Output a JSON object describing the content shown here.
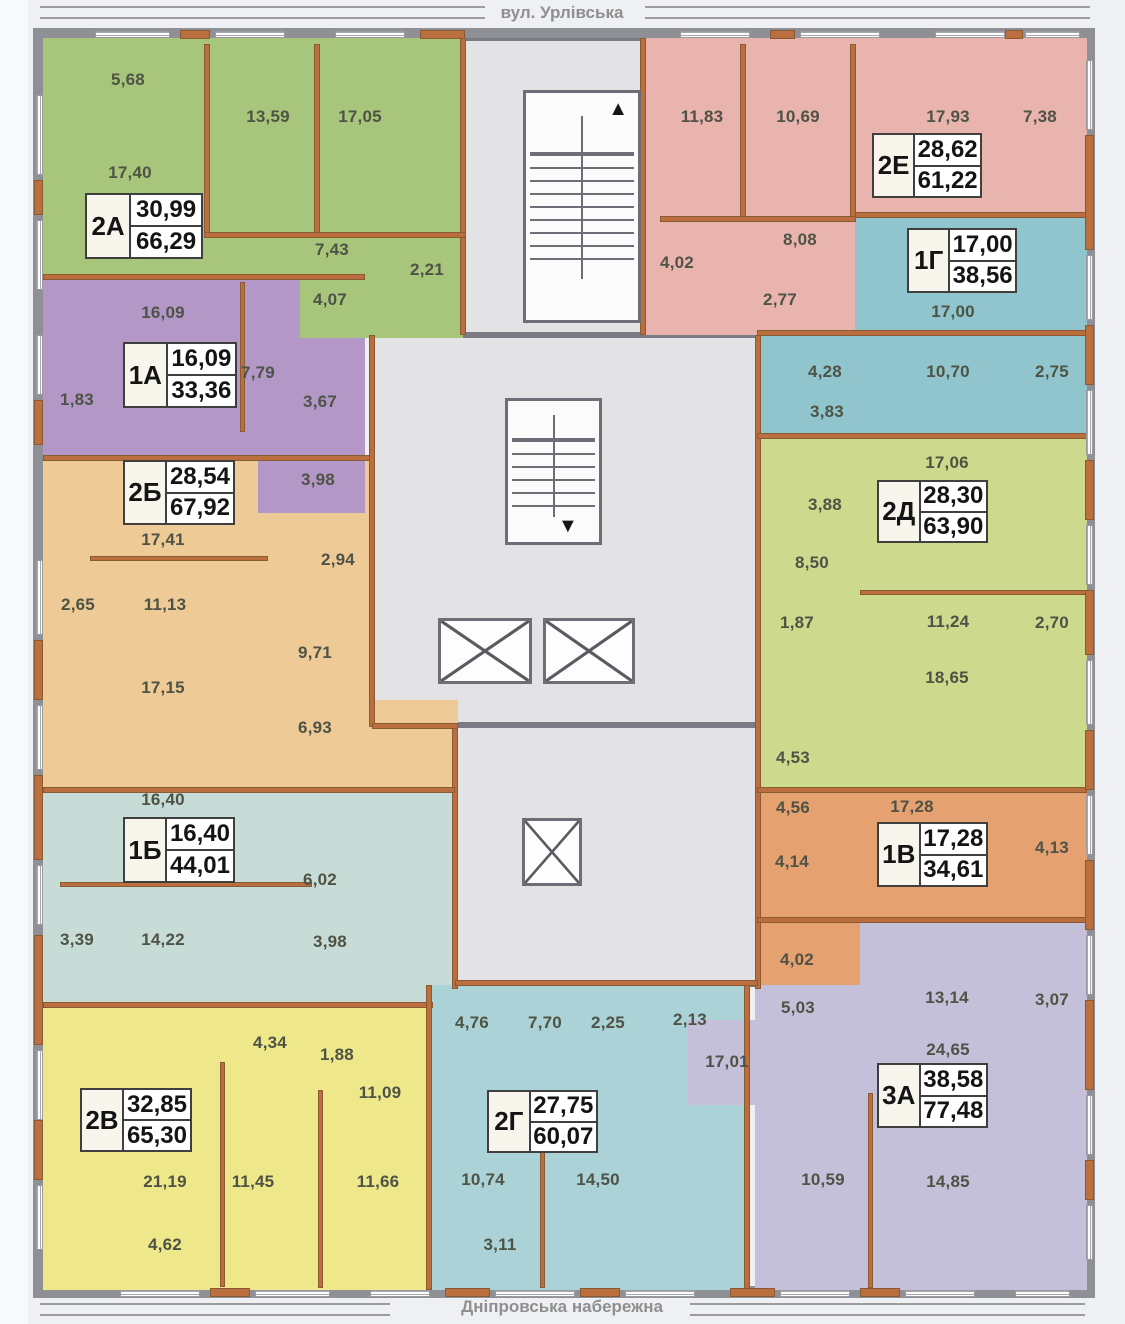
{
  "streets": {
    "top": "вул. Урлівська",
    "bottom": "Дніпровська набережна"
  },
  "legend": {
    "label_format": "apartment id | living area / total area (m²)",
    "room_label_color": "#4e5345",
    "wall_brick_color": "#bb6f3f",
    "wall_gray_color": "#8f8f96"
  },
  "plan": {
    "frame": [
      [
        33,
        28,
        1062,
        12
      ],
      [
        33,
        1286,
        1062,
        12
      ],
      [
        33,
        28,
        12,
        1270
      ],
      [
        1083,
        28,
        12,
        1270
      ]
    ],
    "core": {
      "rects": [
        [
          463,
          38,
          180,
          297
        ],
        [
          372,
          335,
          386,
          390
        ],
        [
          455,
          725,
          303,
          262
        ]
      ],
      "stairs": [
        {
          "rect": [
            523,
            90,
            118,
            233
          ],
          "dir": "up",
          "arrow": "▲"
        },
        {
          "rect": [
            505,
            398,
            97,
            147
          ],
          "dir": "down",
          "arrow": "▼"
        }
      ],
      "elevators": [
        [
          438,
          618,
          94,
          66
        ],
        [
          543,
          618,
          92,
          66
        ],
        [
          522,
          818,
          60,
          68
        ]
      ]
    },
    "apartments": [
      {
        "id": "2Б",
        "living": "28,54",
        "total": "67,92",
        "color": "#eeca96",
        "label": [
          123,
          460,
          112,
          65
        ],
        "regions": [
          [
            43,
            458,
            327,
            332
          ],
          [
            370,
            700,
            88,
            92
          ]
        ],
        "rooms": [
          {
            "v": "17,41",
            "x": 163,
            "y": 540
          },
          {
            "v": "2,94",
            "x": 338,
            "y": 560
          },
          {
            "v": "2,65",
            "x": 78,
            "y": 605
          },
          {
            "v": "11,13",
            "x": 165,
            "y": 605
          },
          {
            "v": "9,71",
            "x": 315,
            "y": 653
          },
          {
            "v": "17,15",
            "x": 163,
            "y": 688
          },
          {
            "v": "6,93",
            "x": 315,
            "y": 728
          }
        ]
      },
      {
        "id": "1А",
        "living": "16,09",
        "total": "33,36",
        "color": "#b297c7",
        "label": [
          123,
          342,
          114,
          66
        ],
        "regions": [
          [
            43,
            278,
            322,
            180
          ],
          [
            258,
            458,
            107,
            55
          ]
        ],
        "rooms": [
          {
            "v": "16,09",
            "x": 163,
            "y": 313
          },
          {
            "v": "7,79",
            "x": 258,
            "y": 373
          },
          {
            "v": "1,83",
            "x": 77,
            "y": 400
          },
          {
            "v": "3,67",
            "x": 320,
            "y": 402
          },
          {
            "v": "3,98",
            "x": 318,
            "y": 480
          }
        ]
      },
      {
        "id": "2А",
        "living": "30,99",
        "total": "66,29",
        "color": "#a7c67b",
        "label": [
          85,
          193,
          118,
          66
        ],
        "regions": [
          [
            43,
            38,
            420,
            240
          ],
          [
            300,
            278,
            163,
            60
          ]
        ],
        "rooms": [
          {
            "v": "5,68",
            "x": 128,
            "y": 80
          },
          {
            "v": "13,59",
            "x": 268,
            "y": 117
          },
          {
            "v": "17,05",
            "x": 360,
            "y": 117
          },
          {
            "v": "17,40",
            "x": 130,
            "y": 173
          },
          {
            "v": "7,43",
            "x": 332,
            "y": 250
          },
          {
            "v": "2,21",
            "x": 427,
            "y": 270
          },
          {
            "v": "4,07",
            "x": 330,
            "y": 300
          }
        ]
      },
      {
        "id": "1Б",
        "living": "16,40",
        "total": "44,01",
        "color": "#c7dbd7",
        "label": [
          123,
          817,
          112,
          66
        ],
        "regions": [
          [
            43,
            790,
            412,
            215
          ]
        ],
        "rooms": [
          {
            "v": "16,40",
            "x": 163,
            "y": 800
          },
          {
            "v": "6,02",
            "x": 320,
            "y": 880
          },
          {
            "v": "3,39",
            "x": 77,
            "y": 940
          },
          {
            "v": "14,22",
            "x": 163,
            "y": 940
          },
          {
            "v": "3,98",
            "x": 330,
            "y": 942
          }
        ]
      },
      {
        "id": "2В",
        "living": "32,85",
        "total": "65,30",
        "color": "#eee88b",
        "label": [
          80,
          1088,
          112,
          64
        ],
        "regions": [
          [
            43,
            1005,
            387,
            285
          ]
        ],
        "rooms": [
          {
            "v": "4,34",
            "x": 270,
            "y": 1043
          },
          {
            "v": "1,88",
            "x": 337,
            "y": 1055
          },
          {
            "v": "11,09",
            "x": 380,
            "y": 1093
          },
          {
            "v": "21,19",
            "x": 165,
            "y": 1182
          },
          {
            "v": "11,45",
            "x": 253,
            "y": 1182
          },
          {
            "v": "11,66",
            "x": 378,
            "y": 1182
          },
          {
            "v": "4,62",
            "x": 165,
            "y": 1245
          }
        ]
      },
      {
        "id": "2Г",
        "living": "27,75",
        "total": "60,07",
        "color": "#abd2d6",
        "label": [
          487,
          1090,
          111,
          63
        ],
        "regions": [
          [
            430,
            985,
            315,
            305
          ]
        ],
        "rooms": [
          {
            "v": "4,76",
            "x": 472,
            "y": 1023
          },
          {
            "v": "7,70",
            "x": 545,
            "y": 1023
          },
          {
            "v": "2,25",
            "x": 608,
            "y": 1023
          },
          {
            "v": "2,13",
            "x": 690,
            "y": 1020
          },
          {
            "v": "10,74",
            "x": 483,
            "y": 1180
          },
          {
            "v": "14,50",
            "x": 598,
            "y": 1180
          },
          {
            "v": "3,11",
            "x": 500,
            "y": 1245
          }
        ]
      },
      {
        "id": "2Е",
        "living": "28,62",
        "total": "61,22",
        "color": "#e9b3ae",
        "label": [
          872,
          133,
          110,
          65
        ],
        "regions": [
          [
            640,
            38,
            447,
            177
          ],
          [
            640,
            215,
            215,
            120
          ]
        ],
        "rooms": [
          {
            "v": "11,83",
            "x": 702,
            "y": 117
          },
          {
            "v": "10,69",
            "x": 798,
            "y": 117
          },
          {
            "v": "17,93",
            "x": 948,
            "y": 117
          },
          {
            "v": "7,38",
            "x": 1040,
            "y": 117
          },
          {
            "v": "8,08",
            "x": 800,
            "y": 240
          },
          {
            "v": "4,02",
            "x": 677,
            "y": 263
          },
          {
            "v": "2,77",
            "x": 780,
            "y": 300
          }
        ]
      },
      {
        "id": "1Г",
        "living": "17,00",
        "total": "38,56",
        "color": "#90c5ce",
        "label": [
          907,
          228,
          110,
          65
        ],
        "regions": [
          [
            855,
            215,
            232,
            222
          ],
          [
            755,
            335,
            332,
            102
          ]
        ],
        "rooms": [
          {
            "v": "17,00",
            "x": 953,
            "y": 312
          },
          {
            "v": "4,28",
            "x": 825,
            "y": 372
          },
          {
            "v": "10,70",
            "x": 948,
            "y": 372
          },
          {
            "v": "2,75",
            "x": 1052,
            "y": 372
          },
          {
            "v": "3,83",
            "x": 827,
            "y": 412
          }
        ]
      },
      {
        "id": "2Д",
        "living": "28,30",
        "total": "63,90",
        "color": "#cdd98c",
        "label": [
          877,
          480,
          111,
          63
        ],
        "regions": [
          [
            757,
            437,
            330,
            353
          ]
        ],
        "rooms": [
          {
            "v": "17,06",
            "x": 947,
            "y": 463
          },
          {
            "v": "3,88",
            "x": 825,
            "y": 505
          },
          {
            "v": "8,50",
            "x": 812,
            "y": 563
          },
          {
            "v": "1,87",
            "x": 797,
            "y": 623
          },
          {
            "v": "11,24",
            "x": 948,
            "y": 622
          },
          {
            "v": "2,70",
            "x": 1052,
            "y": 623
          },
          {
            "v": "18,65",
            "x": 947,
            "y": 678
          },
          {
            "v": "4,53",
            "x": 793,
            "y": 758
          }
        ]
      },
      {
        "id": "1В",
        "living": "17,28",
        "total": "34,61",
        "color": "#e6a171",
        "label": [
          877,
          822,
          111,
          65
        ],
        "regions": [
          [
            757,
            790,
            330,
            130
          ],
          [
            757,
            920,
            103,
            65
          ]
        ],
        "rooms": [
          {
            "v": "4,56",
            "x": 793,
            "y": 808
          },
          {
            "v": "17,28",
            "x": 912,
            "y": 807
          },
          {
            "v": "4,14",
            "x": 792,
            "y": 862
          },
          {
            "v": "4,13",
            "x": 1052,
            "y": 848
          },
          {
            "v": "4,02",
            "x": 797,
            "y": 960
          }
        ]
      },
      {
        "id": "3А",
        "living": "38,58",
        "total": "77,48",
        "color": "#c4c0d9",
        "label": [
          877,
          1063,
          111,
          65
        ],
        "regions": [
          [
            860,
            920,
            227,
            370
          ],
          [
            755,
            985,
            105,
            305
          ],
          [
            688,
            1020,
            75,
            85
          ]
        ],
        "rooms": [
          {
            "v": "13,14",
            "x": 947,
            "y": 998
          },
          {
            "v": "3,07",
            "x": 1052,
            "y": 1000
          },
          {
            "v": "5,03",
            "x": 798,
            "y": 1008
          },
          {
            "v": "17,01",
            "x": 727,
            "y": 1062
          },
          {
            "v": "24,65",
            "x": 948,
            "y": 1050
          },
          {
            "v": "10,59",
            "x": 823,
            "y": 1180
          },
          {
            "v": "14,85",
            "x": 948,
            "y": 1182
          }
        ]
      }
    ],
    "walls": [
      [
        460,
        38,
        6,
        297
      ],
      [
        640,
        38,
        6,
        297
      ],
      [
        369,
        335,
        6,
        392
      ],
      [
        452,
        727,
        6,
        262
      ],
      [
        372,
        723,
        86,
        6
      ],
      [
        755,
        335,
        6,
        654
      ],
      [
        43,
        274,
        322,
        6
      ],
      [
        43,
        455,
        327,
        6
      ],
      [
        43,
        787,
        412,
        6
      ],
      [
        43,
        1002,
        390,
        6
      ],
      [
        855,
        212,
        232,
        6
      ],
      [
        757,
        433,
        330,
        6
      ],
      [
        757,
        787,
        330,
        6
      ],
      [
        757,
        917,
        330,
        6
      ],
      [
        204,
        44,
        6,
        192
      ],
      [
        314,
        44,
        6,
        192
      ],
      [
        204,
        232,
        262,
        6
      ],
      [
        740,
        44,
        6,
        176
      ],
      [
        850,
        44,
        6,
        176
      ],
      [
        660,
        216,
        196,
        6
      ],
      [
        240,
        282,
        5,
        150
      ],
      [
        90,
        556,
        178,
        5
      ],
      [
        60,
        882,
        252,
        5
      ],
      [
        220,
        1062,
        5,
        225
      ],
      [
        318,
        1090,
        5,
        198
      ],
      [
        540,
        1093,
        5,
        195
      ],
      [
        868,
        1093,
        5,
        195
      ],
      [
        860,
        590,
        227,
        5
      ],
      [
        426,
        985,
        6,
        305
      ],
      [
        744,
        985,
        6,
        305
      ],
      [
        757,
        330,
        330,
        6
      ],
      [
        455,
        980,
        303,
        6
      ]
    ],
    "windows": {
      "horizontal": [
        [
          95,
          31,
          75
        ],
        [
          215,
          31,
          70
        ],
        [
          335,
          31,
          70
        ],
        [
          680,
          31,
          70
        ],
        [
          800,
          31,
          80
        ],
        [
          935,
          31,
          70
        ],
        [
          1025,
          31,
          55
        ],
        [
          120,
          1290,
          80
        ],
        [
          255,
          1290,
          75
        ],
        [
          370,
          1290,
          60
        ],
        [
          495,
          1290,
          80
        ],
        [
          625,
          1290,
          70
        ],
        [
          780,
          1290,
          70
        ],
        [
          905,
          1290,
          70
        ],
        [
          1015,
          1290,
          55
        ]
      ],
      "vertical": [
        [
          36,
          95,
          80
        ],
        [
          36,
          220,
          70
        ],
        [
          36,
          335,
          60
        ],
        [
          36,
          560,
          75
        ],
        [
          36,
          705,
          65
        ],
        [
          36,
          865,
          60
        ],
        [
          36,
          1050,
          70
        ],
        [
          36,
          1185,
          65
        ],
        [
          1086,
          60,
          70
        ],
        [
          1086,
          255,
          65
        ],
        [
          1086,
          390,
          65
        ],
        [
          1086,
          525,
          60
        ],
        [
          1086,
          660,
          65
        ],
        [
          1086,
          795,
          60
        ],
        [
          1086,
          935,
          60
        ],
        [
          1086,
          1095,
          60
        ],
        [
          1086,
          1205,
          55
        ]
      ]
    },
    "bricks": [
      [
        180,
        30,
        30,
        9
      ],
      [
        420,
        30,
        45,
        9
      ],
      [
        770,
        30,
        25,
        9
      ],
      [
        1005,
        30,
        18,
        9
      ],
      [
        210,
        1288,
        40,
        9
      ],
      [
        445,
        1288,
        45,
        9
      ],
      [
        580,
        1288,
        40,
        9
      ],
      [
        730,
        1288,
        45,
        9
      ],
      [
        860,
        1288,
        40,
        9
      ],
      [
        34,
        180,
        9,
        35
      ],
      [
        34,
        400,
        9,
        45
      ],
      [
        34,
        640,
        9,
        60
      ],
      [
        34,
        775,
        9,
        85
      ],
      [
        34,
        935,
        9,
        110
      ],
      [
        34,
        1120,
        9,
        60
      ],
      [
        1085,
        135,
        9,
        115
      ],
      [
        1085,
        325,
        9,
        60
      ],
      [
        1085,
        460,
        9,
        60
      ],
      [
        1085,
        590,
        9,
        65
      ],
      [
        1085,
        730,
        9,
        60
      ],
      [
        1085,
        860,
        9,
        70
      ],
      [
        1085,
        1000,
        9,
        90
      ],
      [
        1085,
        1160,
        9,
        40
      ]
    ]
  }
}
